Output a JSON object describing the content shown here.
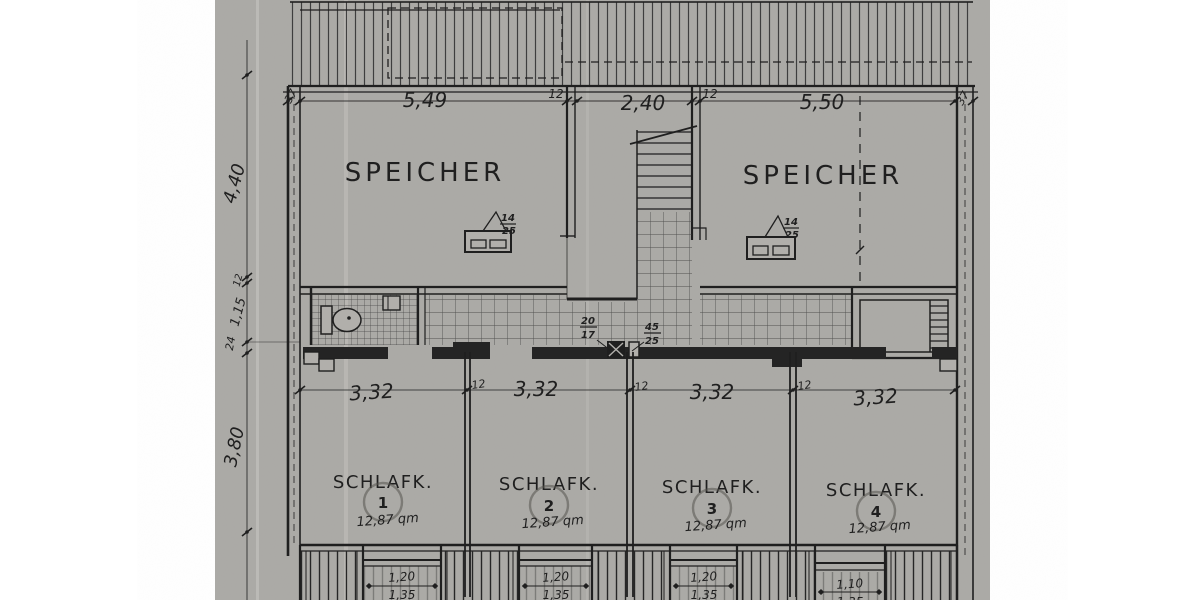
{
  "colors": {
    "paper": "#b1afab",
    "ink": "#1f1f1f",
    "margin": "#ffffff",
    "pencil": "#56534e"
  },
  "attics": [
    {
      "label": "SPEICHER",
      "chimney": {
        "num": "14",
        "den": "25"
      }
    },
    {
      "label": "SPEICHER",
      "chimney": {
        "num": "14",
        "den": "25"
      }
    }
  ],
  "bedrooms": [
    {
      "label": "SCHLAFK.",
      "number": "1",
      "area": "12,87 qm"
    },
    {
      "label": "SCHLAFK.",
      "number": "2",
      "area": "12,87 qm"
    },
    {
      "label": "SCHLAFK.",
      "number": "3",
      "area": "12,87 qm"
    },
    {
      "label": "SCHLAFK.",
      "number": "4",
      "area": "12,87 qm"
    }
  ],
  "ducts": {
    "left": {
      "num": "20",
      "den": "17"
    },
    "right": {
      "num": "45",
      "den": "25"
    }
  },
  "dimensions": {
    "top": {
      "wall_left": "37",
      "span_left": "5,49",
      "wall_mid_left": "12",
      "span_mid": "2,40",
      "wall_mid_right": "12",
      "span_right": "5,50",
      "wall_right": "37"
    },
    "left": {
      "attic_depth": "4,40",
      "wall": "12",
      "corridor": "1,15",
      "wall2": "24",
      "bedroom_depth": "3,80"
    },
    "middle": {
      "rooms": [
        "3,32",
        "3,32",
        "3,32",
        "3,32"
      ],
      "walls": [
        "12",
        "12",
        "12"
      ]
    },
    "bottom": [
      {
        "width": "1,20",
        "inner": "1,35"
      },
      {
        "width": "1,20",
        "inner": "1,35"
      },
      {
        "width": "1,20",
        "inner": "1,35"
      },
      {
        "width": "1,10",
        "inner": "1,35"
      }
    ]
  }
}
